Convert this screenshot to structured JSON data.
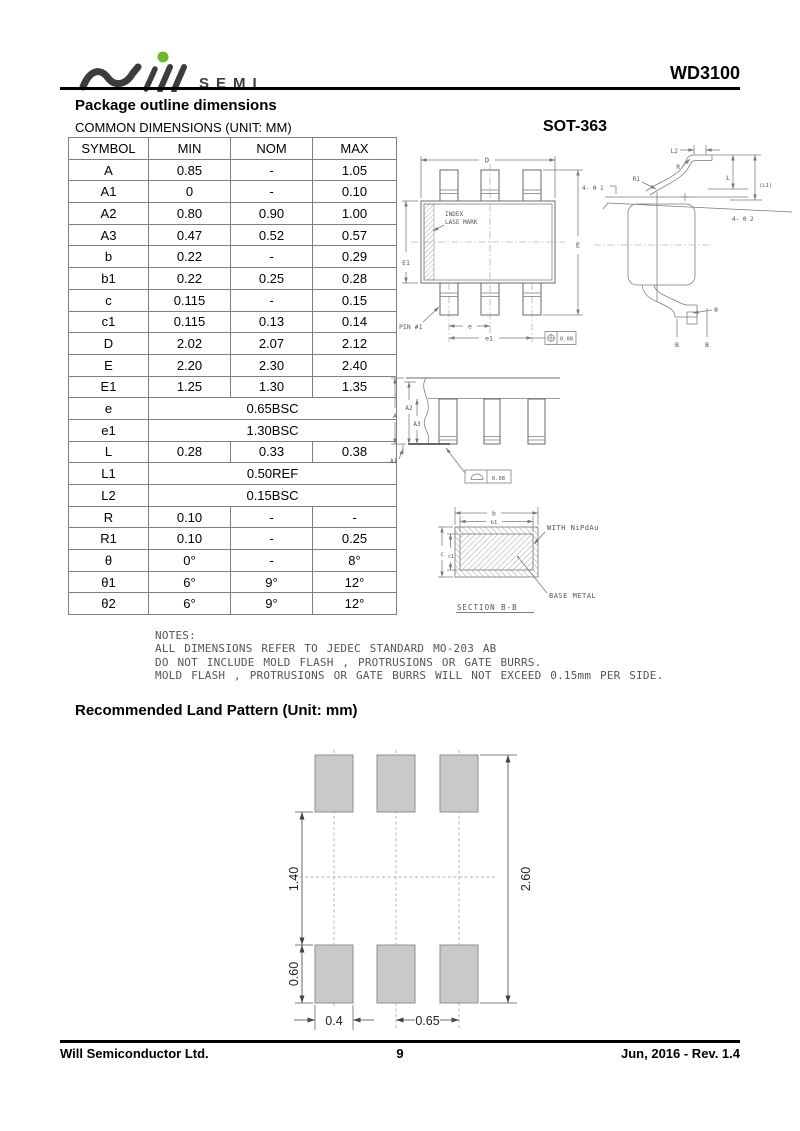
{
  "header": {
    "logo_text": "SEMI",
    "part_number": "WD3100"
  },
  "package_section": {
    "title": "Package outline dimensions",
    "subtitle": "COMMON DIMENSIONS (UNIT: MM)"
  },
  "dimensions_table": {
    "headers": [
      "SYMBOL",
      "MIN",
      "NOM",
      "MAX"
    ],
    "rows": [
      {
        "symbol": "A",
        "min": "0.85",
        "nom": "-",
        "max": "1.05"
      },
      {
        "symbol": "A1",
        "min": "0",
        "nom": "-",
        "max": "0.10"
      },
      {
        "symbol": "A2",
        "min": "0.80",
        "nom": "0.90",
        "max": "1.00"
      },
      {
        "symbol": "A3",
        "min": "0.47",
        "nom": "0.52",
        "max": "0.57"
      },
      {
        "symbol": "b",
        "min": "0.22",
        "nom": "-",
        "max": "0.29"
      },
      {
        "symbol": "b1",
        "min": "0.22",
        "nom": "0.25",
        "max": "0.28"
      },
      {
        "symbol": "c",
        "min": "0.115",
        "nom": "-",
        "max": "0.15"
      },
      {
        "symbol": "c1",
        "min": "0.115",
        "nom": "0.13",
        "max": "0.14"
      },
      {
        "symbol": "D",
        "min": "2.02",
        "nom": "2.07",
        "max": "2.12"
      },
      {
        "symbol": "E",
        "min": "2.20",
        "nom": "2.30",
        "max": "2.40"
      },
      {
        "symbol": "E1",
        "min": "1.25",
        "nom": "1.30",
        "max": "1.35"
      },
      {
        "symbol": "e",
        "span": "0.65BSC"
      },
      {
        "symbol": "e1",
        "span": "1.30BSC"
      },
      {
        "symbol": "L",
        "min": "0.28",
        "nom": "0.33",
        "max": "0.38"
      },
      {
        "symbol": "L1",
        "span": "0.50REF"
      },
      {
        "symbol": "L2",
        "span": "0.15BSC"
      },
      {
        "symbol": "R",
        "min": "0.10",
        "nom": "-",
        "max": "-"
      },
      {
        "symbol": "R1",
        "min": "0.10",
        "nom": "-",
        "max": "0.25"
      },
      {
        "symbol": "θ",
        "min": "0°",
        "nom": "-",
        "max": "8°"
      },
      {
        "symbol": "θ1",
        "min": "6°",
        "nom": "9°",
        "max": "12°"
      },
      {
        "symbol": "θ2",
        "min": "6°",
        "nom": "9°",
        "max": "12°"
      }
    ]
  },
  "drawings": {
    "package_name": "SOT-363",
    "top_view": {
      "d": "D",
      "e1_body": "E1",
      "e_overall": "E",
      "index_line1": "INDEX",
      "index_line2": "LASE MARK",
      "pin1": "PIN #1",
      "pitch_e": "e",
      "pitch_e1": "e1",
      "tolerance": "0.08"
    },
    "side_view": {
      "l2": "L2",
      "r": "R",
      "r1": "R1",
      "l": "L",
      "l1": "(L1)",
      "angle1": "4- θ 1",
      "angle2": "4- θ 2",
      "theta": "θ",
      "b_left": "B",
      "b_right": "B"
    },
    "front_view": {
      "a": "A",
      "a2": "A2",
      "a3": "A3",
      "a1": "A1",
      "tolerance": "0.08"
    },
    "section_bb": {
      "b": "b",
      "b1": "b1",
      "c": "c",
      "c1": "c1",
      "plating_note": "WITH NiPdAu",
      "base_note": "BASE METAL",
      "caption": "SECTION B-B"
    }
  },
  "notes": {
    "title": "NOTES:",
    "lines": [
      "ALL DIMENSIONS REFER TO JEDEC STANDARD MO-203 AB",
      "DO NOT INCLUDE MOLD FLASH , PROTRUSIONS OR GATE BURRS.",
      "MOLD FLASH , PROTRUSIONS OR GATE BURRS WILL NOT EXCEED 0.15mm PER SIDE."
    ]
  },
  "land_pattern": {
    "title": "Recommended Land Pattern (Unit: mm)",
    "row_gap": "1.40",
    "overall_height": "2.60",
    "pad_height": "0.60",
    "pad_width": "0.4",
    "pitch": "0.65"
  },
  "footer": {
    "company": "Will Semiconductor Ltd.",
    "page": "9",
    "revision": "Jun, 2016 - Rev. 1.4"
  },
  "colors": {
    "accent_green": "#6fb82c",
    "logo_gray": "#3c3c3c",
    "line_gray": "#7a7a7a",
    "pad_fill": "#c9c9c9"
  }
}
